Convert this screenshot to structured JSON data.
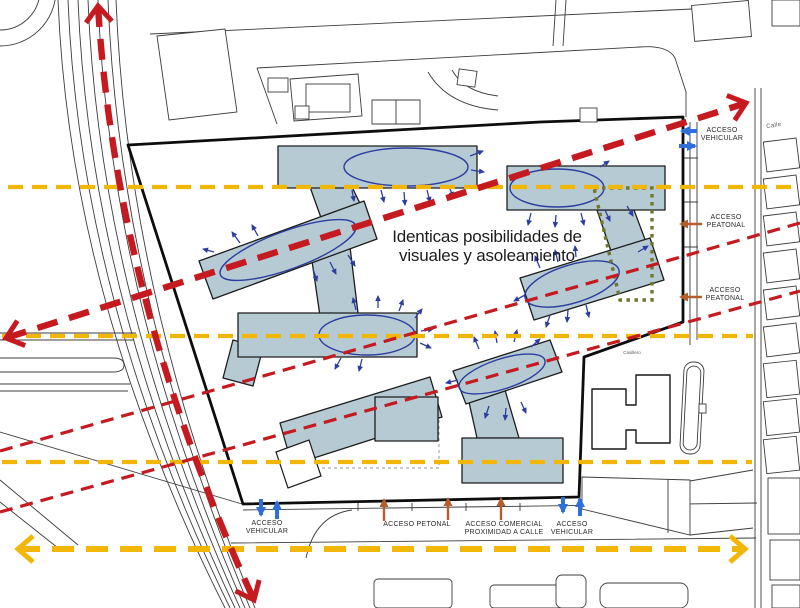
{
  "annotation": {
    "line1": "Identicas posibilidades de",
    "line2": "visuales y asoleamiento"
  },
  "access_labels": {
    "top_right_vehicular": {
      "line1": "ACCESO",
      "line2": "VEHICULAR"
    },
    "right_peatonal_1": {
      "line1": "ACCESO",
      "line2": "PEATONAL"
    },
    "right_peatonal_2": {
      "line1": "ACCESO",
      "line2": "PEATONAL"
    },
    "bottom_vehicular_left": {
      "line1": "ACCESO",
      "line2": "VEHICULAR"
    },
    "bottom_petonal": {
      "label": "ACCESO PETONAL"
    },
    "bottom_comercial": {
      "line1": "ACCESO COMERCIAL",
      "line2": "PROXIMIDAD A CALLE"
    },
    "bottom_vehicular_right": {
      "line1": "ACCESO",
      "line2": "VEHICULAR"
    }
  },
  "context_labels": {
    "street_top_right": "Calle",
    "small_building": "Casillero"
  },
  "icons": {
    "red_axis_arrow": "dashed-view-axis-arrow",
    "yellow_axis_arrow": "dashed-sun-axis-arrow",
    "blue_access_arrow": "vehicular-access-arrow",
    "orange_access_arrow": "pedestrian-access-arrow",
    "sun_view_arrow": "radiating-exposure-arrow"
  },
  "colors": {
    "building_fill": "#b6cad3",
    "building_stroke": "#1d1d1d",
    "site_boundary": "#0d0d0d",
    "context_line": "#3c3c3c",
    "red": "#c41a20",
    "yellow": "#f2b705",
    "blue": "#2f6fd8",
    "orange": "#b45f2b",
    "ellipse_blue": "#2c3da0",
    "olive": "#70752f"
  }
}
